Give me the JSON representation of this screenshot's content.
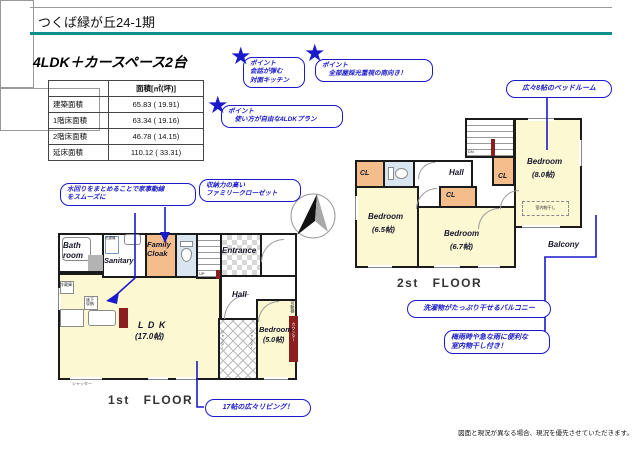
{
  "header": {
    "title": "つくば緑が丘24-1期"
  },
  "plan_title": "4LDK＋カースペース2台",
  "area_table": {
    "col_header": "面積[㎡(坪)]",
    "rows": [
      {
        "label": "建築面積",
        "value": "65.83 ( 19.91)"
      },
      {
        "label": "1階床面積",
        "value": "63.34 ( 19.16)"
      },
      {
        "label": "2階床面積",
        "value": "46.78 ( 14.15)"
      },
      {
        "label": "延床面積",
        "value": "110.12 ( 33.31)"
      }
    ]
  },
  "callouts": {
    "point_kitchen": "ポイント\n会話が弾む\n対面キッチン",
    "point_south": "ポイント\n　全部屋採光重視の南向き！",
    "point_4ldk": "ポイント\n　使い方が自由な4LDKプラン",
    "bedroom8": "広々8帖のベッドルーム",
    "mizumawari": "水回りをまとめることで家事動線\nをスムーズに",
    "family_closet": "収納力の高い\nファミリークローゼット",
    "living": "17帖の広々リビング！",
    "balcony": "洗濯物がたっぷり干せるバルコニー",
    "monohoshi": "梅雨時や急な雨に便利な\n室内物干し付き！"
  },
  "floor1": {
    "label": "1st FLOOR",
    "rooms": {
      "bath": "Bath\nroom",
      "sanitary": "Sanitary",
      "family_cloak": "Family\nCloak",
      "entrance": "Entrance",
      "hall": "Hall",
      "ldk": "L D K",
      "ldk_size": "(17.0帖)",
      "bedroom": "Bedroom",
      "bedroom_size": "(5.0帖)"
    },
    "fixtures": {
      "washer": "洗濯機",
      "fridge": "冷蔵庫",
      "floor_storage": "床下\n収納",
      "shutter": "シャッター",
      "counter": "カウンター",
      "shelf": "可動棚",
      "up": "UP"
    }
  },
  "floor2": {
    "label": "2st FLOOR",
    "rooms": {
      "hall": "Hall",
      "cl": "CL",
      "bedroom65": "Bedroom",
      "bedroom65_size": "(6.5帖)",
      "bedroom67": "Bedroom",
      "bedroom67_size": "(6.7帖)",
      "bedroom80": "Bedroom",
      "bedroom80_size": "(8.0帖)",
      "balcony": "Balcony",
      "dn": "DN",
      "monohoshi": "室内物干し"
    }
  },
  "footer": {
    "disclaimer": "図面と現況が異なる場合、現況を優先させていただきます。"
  }
}
